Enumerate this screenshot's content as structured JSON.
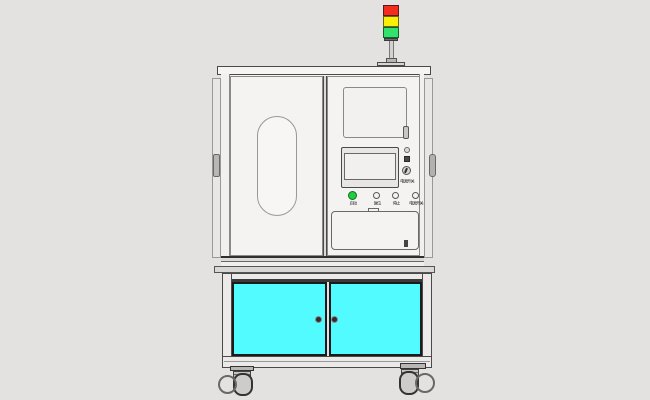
{
  "scene": {
    "description": "CAD rendering of an industrial inspection machine on a caster stand",
    "background_color": "#e4e2e0"
  },
  "signal_tower": {
    "segments": [
      {
        "name": "red-light",
        "color": "#f42c1e"
      },
      {
        "name": "yellow-light",
        "color": "#f8ee06"
      },
      {
        "name": "green-light",
        "color": "#33e26c"
      }
    ]
  },
  "control_panel": {
    "key_switch_label": "电源开关",
    "buttons": [
      {
        "label": "启动",
        "color": "#1fce3e"
      },
      {
        "label": "复位",
        "color": "#f4f3f1"
      },
      {
        "label": "停止",
        "color": "#f4f3f1"
      },
      {
        "label": "电源开关",
        "color": "#f4f3f1"
      }
    ]
  },
  "lower_cabinet": {
    "door_color": "#52fbff"
  }
}
